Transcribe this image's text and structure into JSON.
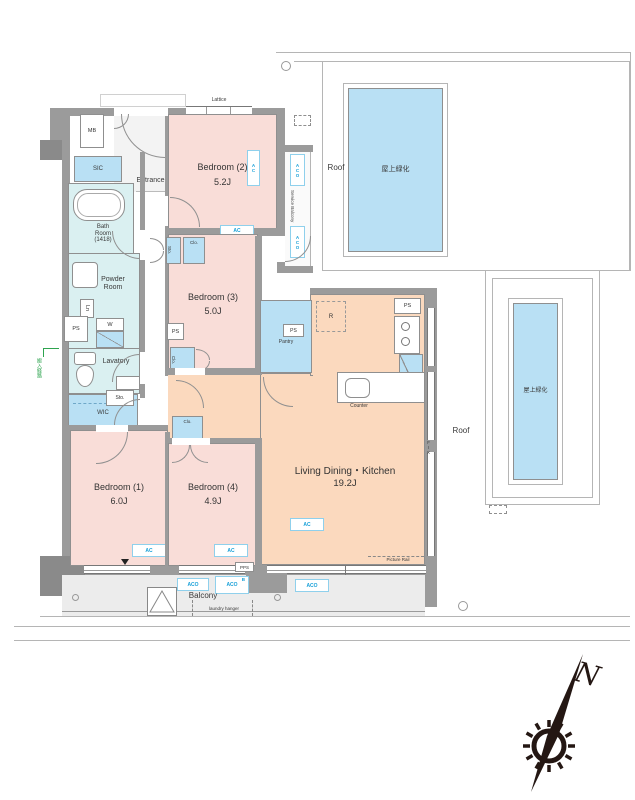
{
  "plan": {
    "rooms": {
      "bedroom1": {
        "name": "Bedroom (1)",
        "area": "6.0J"
      },
      "bedroom2": {
        "name": "Bedroom (2)",
        "area": "5.2J"
      },
      "bedroom3": {
        "name": "Bedroom (3)",
        "area": "5.0J"
      },
      "bedroom4": {
        "name": "Bedroom (4)",
        "area": "4.9J"
      },
      "ldk": {
        "name": "Living Dining・Kitchen",
        "area": "19.2J"
      },
      "bath": {
        "name_line1": "Bath",
        "name_line2": "Room",
        "name_line3": "(1418)"
      },
      "powder": {
        "name_line1": "Powder",
        "name_line2": "Room"
      },
      "lavatory": {
        "name": "Lavatory"
      },
      "entrance": {
        "name": "Entrance"
      },
      "wic": {
        "name": "WIC"
      },
      "pantry": {
        "name": "Pantry"
      },
      "balcony": {
        "name": "Balcony"
      },
      "service_balcony": {
        "name": "Service Balcony"
      }
    },
    "fixtures": {
      "mb": "MB",
      "sic": "SIC",
      "ps": "PS",
      "pps": "PPS",
      "w": "W",
      "ln": "Ln",
      "r": "R",
      "sto": "Sto.",
      "clo": "Clo.",
      "ac": "AC",
      "aco": "ACO",
      "b": "B",
      "fix": "FIX",
      "counter": "Counter",
      "lattice": "Lattice",
      "picture_rail": "Picture Rail",
      "laundry_hanger": "laundry hanger"
    },
    "exterior": {
      "roof": "Roof",
      "green_roof": "屋上緑化",
      "route_note": "搬入経路",
      "compass_north": "N"
    },
    "colors": {
      "bedroom_pink": "#f9ddd8",
      "ldk_peach": "#fbd9be",
      "wet_cyan": "#daf0f1",
      "storage_blue": "#b9e0f4",
      "wall_gray": "#9b9b9b",
      "balcony_gray": "#ececec",
      "ac_label_blue": "#18a0d8",
      "roof_line_gray": "#b5b5b5",
      "route_green": "#2ea44f"
    }
  }
}
